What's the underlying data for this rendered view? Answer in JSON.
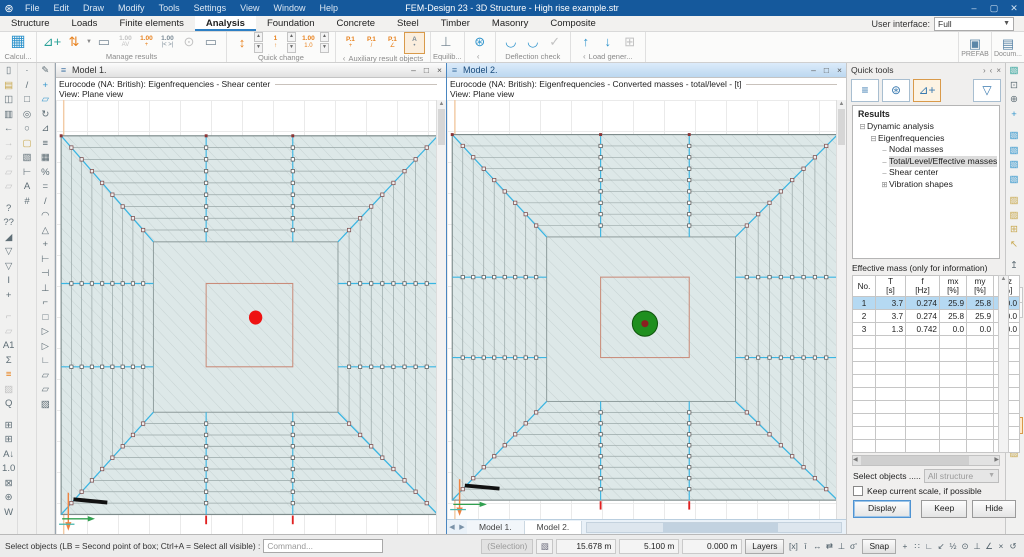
{
  "colors": {
    "accent": "#15599c",
    "canvas_fill": "#dde8e8",
    "cyan": "#3ab5e2",
    "red_marker": "#ee1212",
    "green_mass": "#1f8f1f",
    "grid": "#eaeaea"
  },
  "titlebar": {
    "title": "FEM-Design 23 - 3D Structure - High rise example.str",
    "menus": [
      "File",
      "Edit",
      "Draw",
      "Modify",
      "Tools",
      "Settings",
      "View",
      "Window",
      "Help"
    ],
    "controls": [
      {
        "n": "minimize",
        "g": "–"
      },
      {
        "n": "maximize",
        "g": "▢"
      },
      {
        "n": "close",
        "g": "✕"
      }
    ]
  },
  "tabs": {
    "items": [
      "Structure",
      "Loads",
      "Finite elements",
      "Analysis",
      "Foundation",
      "Concrete",
      "Steel",
      "Timber",
      "Masonry",
      "Composite"
    ],
    "active": "Analysis",
    "ui_label": "User interface:",
    "ui_value": "Full"
  },
  "ribbon": {
    "groups": [
      {
        "label": "Calcul...",
        "icons": [
          {
            "n": "calculate",
            "g": "▦",
            "c": "bl",
            "big": true
          }
        ]
      },
      {
        "label": "Manage results",
        "icons": [
          {
            "n": "new-result",
            "g": "⊿+",
            "c": "tl"
          },
          {
            "n": "result-updown",
            "g": "⇅",
            "c": "or",
            "dd": true
          },
          {
            "n": "display-options",
            "g": "▭",
            "c": "gr"
          },
          {
            "n": "scale-av",
            "t": "1.00",
            "s": "AV",
            "c": "dis"
          },
          {
            "n": "scale-plus",
            "t": "1.00",
            "s": "+",
            "c": "or"
          },
          {
            "n": "scale-fit",
            "t": "1.00",
            "s": "|< >|",
            "c": "gr"
          },
          {
            "n": "find-extreme",
            "g": "⊙",
            "c": "dis"
          },
          {
            "n": "section-frame",
            "g": "▭",
            "c": "gr"
          }
        ]
      },
      {
        "label": "Quick change",
        "icons": [
          {
            "n": "qc-updown",
            "g": "↕",
            "c": "or",
            "spin": true
          },
          {
            "n": "qc-shape",
            "t": "1",
            "s": "↑",
            "c": "or",
            "spin": true
          },
          {
            "n": "qc-scale",
            "t": "1.00",
            "s": "1.0",
            "c": "or",
            "spin": true
          }
        ]
      },
      {
        "label": "Auxiliary result objects",
        "collapse": true,
        "icons": [
          {
            "n": "result-point-new",
            "t": "P.1",
            "s": "+",
            "c": "or"
          },
          {
            "n": "result-point-diagram",
            "t": "P.1",
            "s": "/",
            "c": "or"
          },
          {
            "n": "result-point-section",
            "t": "P.1",
            "s": "∠",
            "c": "or"
          },
          {
            "n": "annotation",
            "t": "A",
            "s": "•",
            "c": "gr",
            "sel": true
          }
        ]
      },
      {
        "label": "Equilib...",
        "icons": [
          {
            "n": "equilibrium",
            "g": "⊥",
            "c": "gr"
          }
        ]
      },
      {
        "label": "",
        "collapse": true,
        "icons": [
          {
            "n": "settings-gear",
            "g": "⊛",
            "c": "bl"
          }
        ]
      },
      {
        "label": "Deflection check",
        "icons": [
          {
            "n": "deflection-slab",
            "g": "◡",
            "c": "bl"
          },
          {
            "n": "deflection-beam",
            "g": "◡",
            "c": "bl"
          },
          {
            "n": "deflection-ok",
            "g": "✓",
            "c": "dis"
          }
        ]
      },
      {
        "label": "Load gener...",
        "collapse": true,
        "icons": [
          {
            "n": "generate-up",
            "g": "↑",
            "c": "bl"
          },
          {
            "n": "generate-down",
            "g": "↓",
            "c": "bl"
          },
          {
            "n": "generate-copy",
            "g": "⊞",
            "c": "dis"
          }
        ]
      }
    ],
    "right": [
      {
        "n": "prefab",
        "label": "PREFAB",
        "icon": "▣"
      },
      {
        "n": "documentation",
        "label": "Docum...",
        "icon": "▤"
      }
    ]
  },
  "left_toolbar": {
    "col1": [
      {
        "n": "new",
        "g": "▯"
      },
      {
        "n": "open",
        "g": "▤",
        "c": "yw"
      },
      {
        "n": "save",
        "g": "◫"
      },
      {
        "n": "print",
        "g": "▥"
      },
      {
        "n": "undo",
        "g": "←"
      },
      {
        "n": "redo",
        "g": "→",
        "c": "dis"
      },
      {
        "n": "copy-props-1",
        "g": "▱",
        "c": "dis"
      },
      {
        "n": "copy-props-2",
        "g": "▱",
        "c": "dis"
      },
      {
        "n": "copy-props-3",
        "g": "▱",
        "c": "dis"
      },
      {
        "gap": true
      },
      {
        "n": "quick-help",
        "g": "?"
      },
      {
        "n": "what-is",
        "g": "??"
      },
      {
        "n": "filter-solid",
        "g": "◢"
      },
      {
        "n": "filter-funnel",
        "g": "▽"
      },
      {
        "n": "filter-funnel-2",
        "g": "▽"
      },
      {
        "n": "text-cursor",
        "g": "I"
      },
      {
        "n": "crosshair",
        "g": "+"
      },
      {
        "gap": true
      },
      {
        "n": "clip-plane",
        "g": "⌐",
        "c": "dis"
      },
      {
        "n": "region-tool",
        "g": "▱",
        "c": "dis"
      },
      {
        "n": "text-a1",
        "g": "A1"
      },
      {
        "n": "sum-sigma",
        "g": "Σ"
      },
      {
        "n": "layers-color",
        "g": "≡",
        "c": "or"
      },
      {
        "n": "hatch-tool",
        "g": "▨",
        "c": "dis"
      },
      {
        "n": "zoom-q",
        "g": "Q"
      },
      {
        "gap": true
      },
      {
        "n": "table-view",
        "g": "⊞"
      },
      {
        "n": "table-add",
        "g": "⊞"
      },
      {
        "n": "sort-az",
        "g": "A↓"
      },
      {
        "n": "decimals",
        "g": "1.0"
      },
      {
        "n": "lock",
        "g": "⊠"
      },
      {
        "n": "options-gear",
        "g": "⊛"
      },
      {
        "n": "word-export",
        "g": "W"
      }
    ],
    "col2": [
      {
        "n": "point",
        "g": "·"
      },
      {
        "n": "line",
        "g": "/"
      },
      {
        "n": "rectangle",
        "g": "□"
      },
      {
        "n": "circle-radius",
        "g": "◎"
      },
      {
        "n": "circle",
        "g": "○"
      },
      {
        "n": "fill-region",
        "g": "▢",
        "c": "yw"
      },
      {
        "n": "solid-box",
        "g": "▧"
      },
      {
        "n": "dimension",
        "g": "⊢"
      },
      {
        "n": "text",
        "g": "A"
      },
      {
        "n": "raster",
        "g": "#"
      }
    ],
    "col3": [
      {
        "n": "modify",
        "g": "✎"
      },
      {
        "n": "move",
        "g": "+",
        "c": "bl"
      },
      {
        "n": "copy",
        "g": "▱",
        "c": "bl"
      },
      {
        "n": "rotate",
        "g": "↻"
      },
      {
        "n": "mirror",
        "g": "⊿"
      },
      {
        "n": "offset",
        "g": "≡"
      },
      {
        "n": "array",
        "g": "▦"
      },
      {
        "n": "properties",
        "g": "%"
      },
      {
        "n": "make-equal",
        "g": "="
      },
      {
        "n": "divide",
        "g": "/"
      },
      {
        "n": "arc-modify",
        "g": "◠"
      },
      {
        "n": "fillet",
        "g": "△"
      },
      {
        "n": "intersect",
        "g": "+"
      },
      {
        "n": "extend-left",
        "g": "⊢"
      },
      {
        "n": "extend-right",
        "g": "⊣"
      },
      {
        "n": "trim",
        "g": "⊥"
      },
      {
        "n": "chamfer",
        "g": "⌐"
      },
      {
        "n": "face-edit",
        "g": "□"
      },
      {
        "n": "poly-a",
        "g": "▷"
      },
      {
        "n": "poly-b",
        "g": "▷"
      },
      {
        "n": "poly-corner",
        "g": "∟"
      },
      {
        "n": "copy-obj",
        "g": "▱"
      },
      {
        "n": "paste-obj",
        "g": "▱"
      },
      {
        "n": "hatch-obj",
        "g": "▨"
      }
    ]
  },
  "right_toolbar": [
    {
      "n": "palette",
      "g": "▧",
      "c": "tl"
    },
    {
      "n": "fit-view",
      "g": "⊡"
    },
    {
      "n": "zoom-window",
      "g": "⊕"
    },
    {
      "n": "pan",
      "g": "+",
      "c": "bl"
    },
    {
      "gap": true
    },
    {
      "n": "view-top",
      "g": "▧",
      "c": "bl"
    },
    {
      "n": "view-front",
      "g": "▧",
      "c": "bl"
    },
    {
      "n": "view-side",
      "g": "▧",
      "c": "bl"
    },
    {
      "n": "view-iso",
      "g": "▧",
      "c": "bl"
    },
    {
      "gap": true
    },
    {
      "n": "shade-wire",
      "g": "▨",
      "c": "yw"
    },
    {
      "n": "shade-solid",
      "g": "▨",
      "c": "yw"
    },
    {
      "n": "select-add",
      "g": "⊞",
      "c": "yw"
    },
    {
      "n": "select-pick",
      "g": "↖",
      "c": "yw"
    },
    {
      "gap": true
    },
    {
      "n": "storey-up",
      "g": "↥"
    },
    {
      "n": "storey-down",
      "g": "↧"
    },
    {
      "n": "view-prev",
      "g": "←",
      "box": true
    },
    {
      "n": "view-next",
      "g": "→",
      "c": "dis",
      "box": true
    },
    {
      "gap": true
    },
    {
      "n": "copy-view-1",
      "g": "▱"
    },
    {
      "n": "copy-view-2",
      "g": "▱"
    },
    {
      "n": "add-view",
      "g": "⊞"
    },
    {
      "n": "pick-view",
      "g": "↖"
    },
    {
      "n": "filter-view",
      "g": "▽",
      "c": "bl"
    },
    {
      "gap": true
    },
    {
      "n": "cube-ghost",
      "g": "▱",
      "c": "dis"
    },
    {
      "n": "cube-current",
      "g": "▱",
      "sel": true
    },
    {
      "n": "cube-shade-1",
      "g": "▨",
      "c": "yw"
    },
    {
      "n": "cube-shade-2",
      "g": "▨",
      "c": "yw"
    }
  ],
  "models": [
    {
      "title": "Model 1.",
      "line1": "Eurocode (NA: British): Eigenfrequencies - Shear center",
      "line2": "View: Plane view",
      "active": false,
      "marker": "red-dot",
      "controls": [
        {
          "n": "win-minimize",
          "g": "–"
        },
        {
          "n": "win-maximize",
          "g": "□"
        },
        {
          "n": "win-close",
          "g": "×"
        }
      ]
    },
    {
      "title": "Model 2.",
      "line1": "Eurocode (NA: British): Eigenfrequencies - Converted masses - total/level - [t]",
      "line2": "View: Plane view",
      "active": true,
      "marker": "green-mass",
      "controls": [
        {
          "n": "win-minimize",
          "g": "–"
        },
        {
          "n": "win-maximize",
          "g": "□"
        },
        {
          "n": "win-close",
          "g": "×"
        }
      ],
      "tabs": [
        "Model 1.",
        "Model 2."
      ],
      "active_tab": "Model 2."
    }
  ],
  "quick_tools": {
    "title": "Quick tools",
    "head_controls": [
      {
        "n": "panel-undock",
        "g": "›"
      },
      {
        "n": "panel-collapse",
        "g": "‹"
      },
      {
        "n": "panel-close",
        "g": "×"
      }
    ],
    "buttons_top": [
      {
        "n": "qt-list",
        "g": "≡"
      },
      {
        "n": "qt-settings",
        "g": "⊛"
      },
      {
        "n": "qt-new-result",
        "g": "⊿+",
        "sel": true
      }
    ],
    "filter": {
      "n": "qt-filter",
      "g": "▽"
    },
    "results_title": "Results",
    "tree": [
      {
        "label": "Dynamic analysis",
        "level": 0,
        "exp": "minus"
      },
      {
        "label": "Eigenfrequencies",
        "level": 1,
        "exp": "minus"
      },
      {
        "label": "Nodal masses",
        "level": 2,
        "exp": "leaf"
      },
      {
        "label": "Total/Level/Effective masses",
        "level": 2,
        "exp": "leaf",
        "selected": true
      },
      {
        "label": "Shear center",
        "level": 2,
        "exp": "leaf"
      },
      {
        "label": "Vibration shapes",
        "level": 2,
        "exp": "plus"
      }
    ],
    "table": {
      "title": "Effective mass (only for information)",
      "columns": [
        [
          "No.",
          ""
        ],
        [
          "T",
          "[s]"
        ],
        [
          "f",
          "[Hz]"
        ],
        [
          "mx",
          "[%]"
        ],
        [
          "my",
          "[%]"
        ],
        [
          "mz",
          "[%]"
        ]
      ],
      "rows": [
        [
          "1",
          "3.7",
          "0.274",
          "25.9",
          "25.8",
          "0.0"
        ],
        [
          "2",
          "3.7",
          "0.274",
          "25.8",
          "25.9",
          "0.0"
        ],
        [
          "3",
          "1.3",
          "0.742",
          "0.0",
          "0.0",
          "0.0"
        ]
      ],
      "selected_row": 0,
      "empty_rows": 9
    },
    "select_objects_label": "Select objects .....",
    "select_objects_value": "All structure",
    "keep_scale_label": "Keep current scale, if possible",
    "buttons": [
      "Display",
      "Keep",
      "Hide"
    ]
  },
  "statusbar": {
    "prompt": "Select objects (LB = Second point of box; Ctrl+A = Select all visible) :",
    "command_placeholder": "Command...",
    "selection": "(Selection)",
    "coords": [
      "15.678 m",
      "5.100 m",
      "0.000 m"
    ],
    "layers_label": "Layers",
    "snap_label": "Snap",
    "mode_icons": [
      {
        "n": "abs-coord",
        "g": "[x]"
      },
      {
        "n": "rel-coord",
        "g": "ī"
      },
      {
        "n": "horizontal-lock",
        "g": "↔"
      },
      {
        "n": "parallel-lock",
        "g": "⇄"
      },
      {
        "n": "perpendicular-lock",
        "g": "⊥"
      },
      {
        "n": "angle-lock",
        "g": "σ'"
      }
    ],
    "snap_icons": [
      {
        "n": "snap-node",
        "g": "+"
      },
      {
        "n": "snap-grid",
        "g": "∷"
      },
      {
        "n": "snap-ortho",
        "g": "∟"
      },
      {
        "n": "snap-diagonal",
        "g": "↙"
      },
      {
        "n": "snap-midpoint",
        "g": "½"
      },
      {
        "n": "snap-center",
        "g": "⊙"
      },
      {
        "n": "snap-perpendicular",
        "g": "⊥"
      },
      {
        "n": "snap-angle",
        "g": "∠"
      },
      {
        "n": "snap-off",
        "g": "×"
      },
      {
        "n": "snap-cycle",
        "g": "↺"
      }
    ]
  }
}
